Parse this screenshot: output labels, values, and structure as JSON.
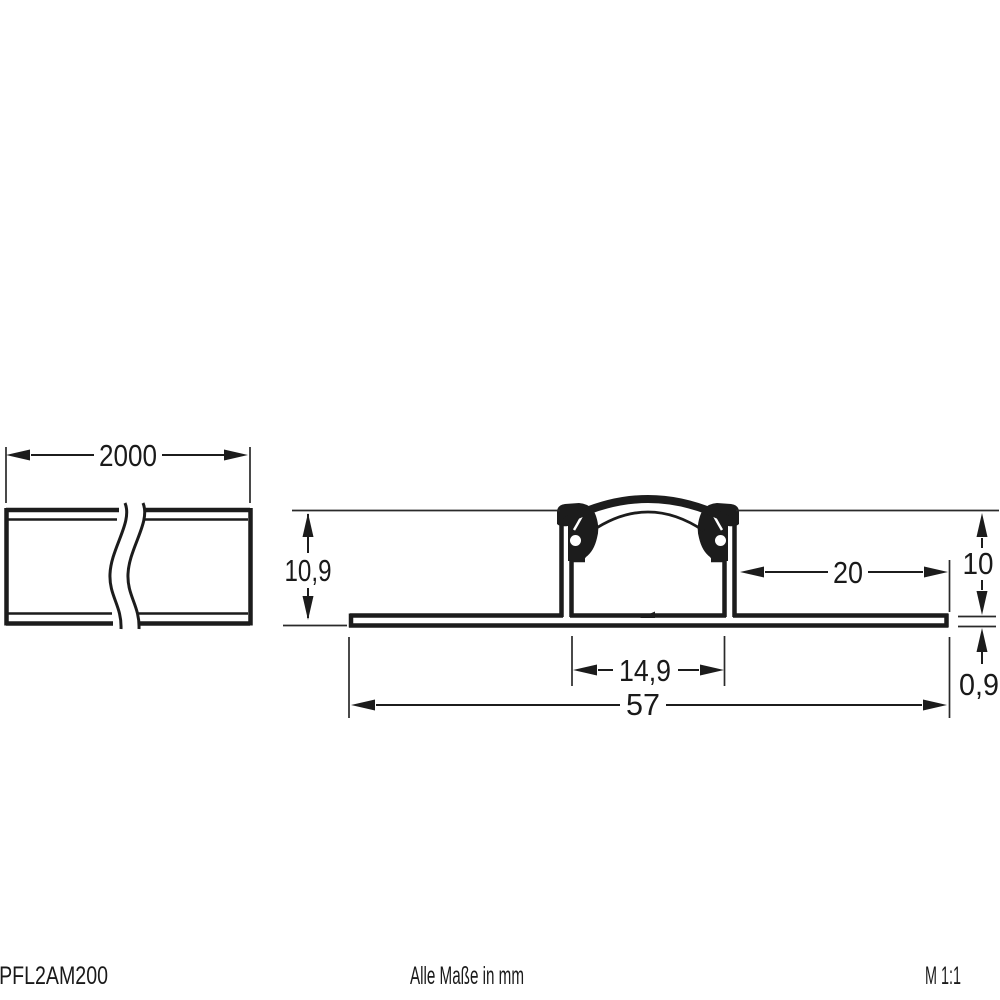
{
  "drawing_title": "LED profile technical drawing",
  "side_view": {
    "length": "2000"
  },
  "cross_section": {
    "total_height": "10,9",
    "body_height": "10",
    "right_flange_width": "20",
    "inner_width": "14,9",
    "total_width": "57",
    "flange_thickness": "0,9"
  },
  "footer": {
    "article": "APFL2AM200",
    "note": "Alle Maße in mm",
    "scale": "M 1:1"
  },
  "colors": {
    "line": "#1c1c1c",
    "background": "#ffffff"
  }
}
